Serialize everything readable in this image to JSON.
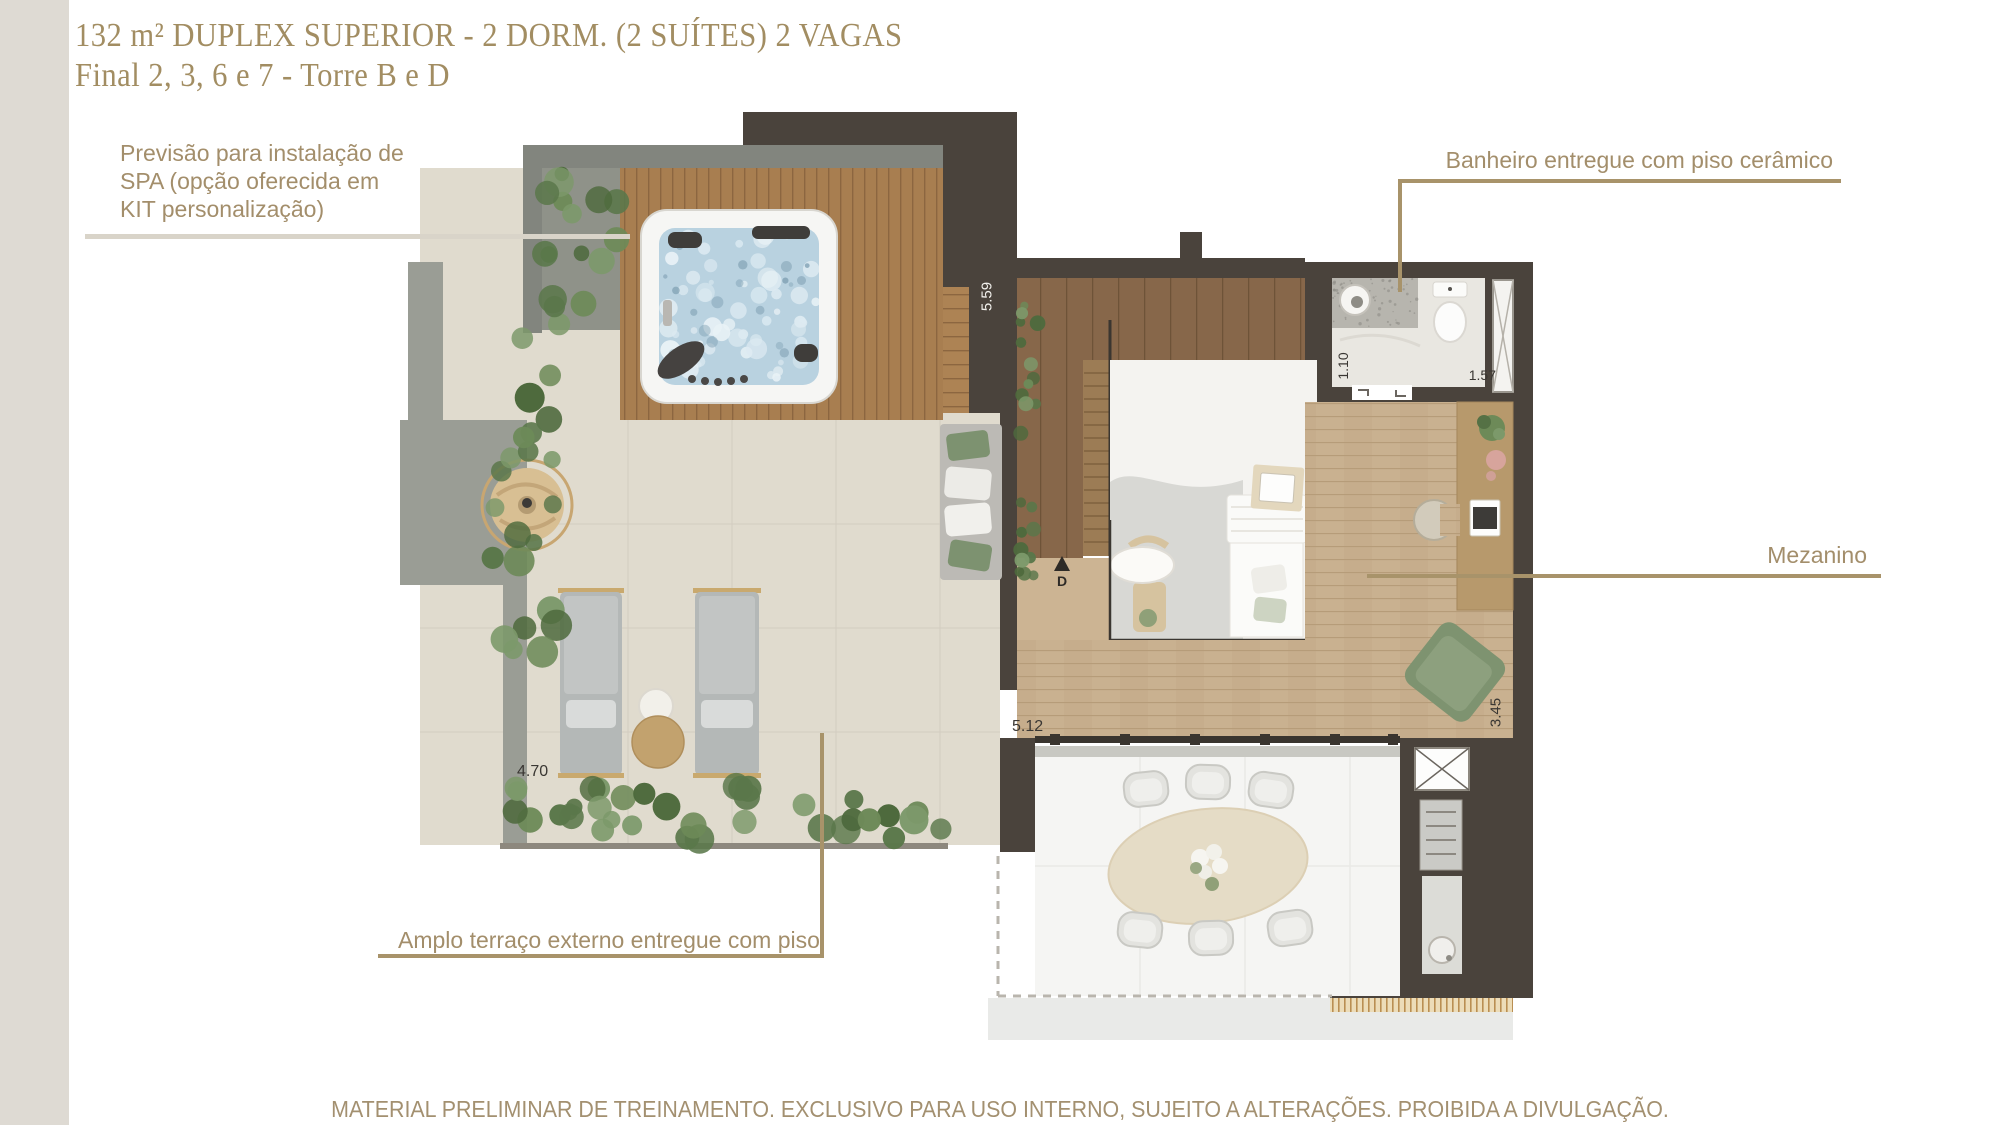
{
  "title": {
    "line1": "132 m² DUPLEX SUPERIOR - 2 DORM. (2 SUÍTES) 2 VAGAS",
    "line2": "Final 2, 3, 6 e 7 - Torre B e D"
  },
  "annotations": {
    "spa": "Previsão para instalação de SPA (opção oferecida em KIT personalização)",
    "bathroom": "Banheiro entregue com piso cerâmico",
    "mezzanine": "Mezanino",
    "terrace": "Amplo terraço externo entregue com piso"
  },
  "dimensions": {
    "d559": "5.59",
    "d110": "1.10",
    "d157": "1.57",
    "d470": "4.70",
    "d512": "5.12",
    "d345": "3.45"
  },
  "compass_letter": "D",
  "footer": "MATERIAL PRELIMINAR DE TREINAMENTO. EXCLUSIVO PARA USO INTERNO, SUJEITO A ALTERAÇÕES. PROIBIDA A DIVULGAÇÃO.",
  "colors": {
    "title_gold": "#a28d62",
    "annotation_tan": "#a38e6b",
    "leader_gold": "#a8936a",
    "leader_light": "#d9d4c9",
    "wall_dark": "#4a433c",
    "wall_gray": "#85887f",
    "deck_wood": "#a87e50",
    "mezzanine_wood": "#c9b190",
    "terrace_tile": "#e0dbce",
    "plant_green": "#6d8a58",
    "spa_water": "#b9d2e0",
    "left_bar": "#dedad3"
  }
}
